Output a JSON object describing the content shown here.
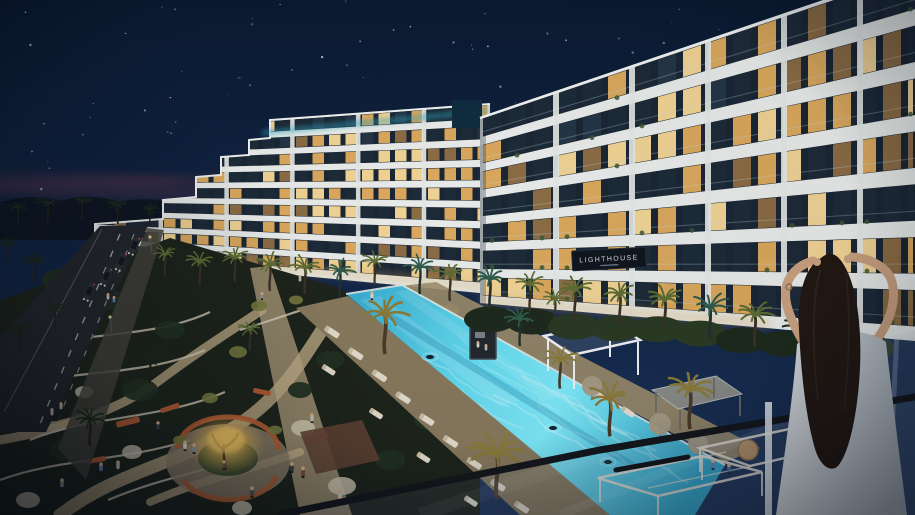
{
  "scene": {
    "type": "architectural night rendering",
    "description": "Aerial evening view of a white terraced residential complex with warm lit apartments, landscaped winding gardens, palm trees, a long glowing turquoise pool, a street with cars on the left, and a woman watching from a glass-railed balcony in the right foreground."
  },
  "sign": {
    "label": "LIGHTHOUSE"
  },
  "counts": {
    "building_wings": 2,
    "center_wing_floors": 9,
    "right_wing_floors": 7
  },
  "colors": {
    "skyTop": "#0b1a31",
    "skyMid": "#13274a",
    "skyLow": "#1d3458",
    "horizonGlow": "#87434e",
    "star": "#d6e4f4",
    "facade": "#e7eae8",
    "pier": "#e3e6e4",
    "stripDark": "#1a2633",
    "winWarm1": "#d9a75c",
    "winWarm2": "#efd193",
    "winDim": "#8a6b44",
    "winDark": "#1d2a38",
    "roofGlow": "#2fa3bd",
    "corePanel": "#0f2d3f",
    "outline": "#eff1ef",
    "signBg": "#10161e",
    "signText": "#d5dbe1",
    "poolA": "#2f9fc4",
    "poolB": "#6fe2f5",
    "poolC": "#2ba0c4",
    "caustic": "#d2f6fc",
    "coping": "#dfe7e3",
    "deckTan": "#87795d",
    "deckWarm": "#9c8d6b",
    "lounger": "#e3dccb",
    "umbrella": "#a79b85",
    "woodDeck": "#5f4333",
    "swimmer": "#16222b",
    "road": "#24272c",
    "roadLine": "#cfd4da",
    "sidewalk": "#45433c",
    "gardenDark": "#1d241b",
    "pathTan": "#c0ad87",
    "wall": "#d8d0bc",
    "bench": "#b15a33",
    "plaza": "#8d7f68",
    "grassRing": "#3c4a2e",
    "treeGlow": "#f2c55e",
    "shrubLit": "#75793f",
    "canopyDark": "#223122",
    "flower": "#cfc8b2",
    "palmDark": "#1c2a1d",
    "palmLit": "#5d6c34",
    "palmGold": "#8a7a3a",
    "palmTeal": "#2f5a4c",
    "trunk": "#3a3126",
    "rail": "#14181d",
    "glassTint": "#7f9ec4",
    "pergola": "#e6e1d4",
    "chair": "#bb9160",
    "post": "#dfe3e6",
    "hair": "#221812",
    "hairShine": "#4a3a2a",
    "skin": "#c8a07f",
    "dressA": "#d6dbdf",
    "dressB": "#a9b2ba",
    "carBody": "#2b3036",
    "carGlass": "#15181c",
    "headlight": "#f5e9c8",
    "taillight": "#d65a4a"
  }
}
